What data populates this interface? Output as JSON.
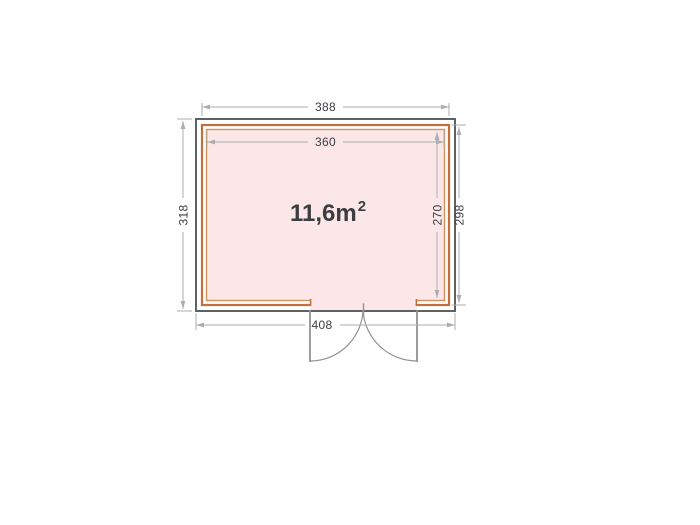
{
  "area": {
    "text": "11,6m",
    "sup": "2"
  },
  "dims": {
    "wall_width": "388",
    "interior_width": "360",
    "roof_depth": "318",
    "interior_depth": "270",
    "wall_depth": "298",
    "roof_width": "408"
  },
  "colors": {
    "outline_gray": "#5e6166",
    "wall_orange": "#c4703a",
    "wall_orange_light": "#d2925f",
    "interior_pink": "#fbe7e8",
    "door_gray": "#8f9194",
    "dim_gray": "#abaeb1",
    "text_dark": "#3b3d40"
  }
}
